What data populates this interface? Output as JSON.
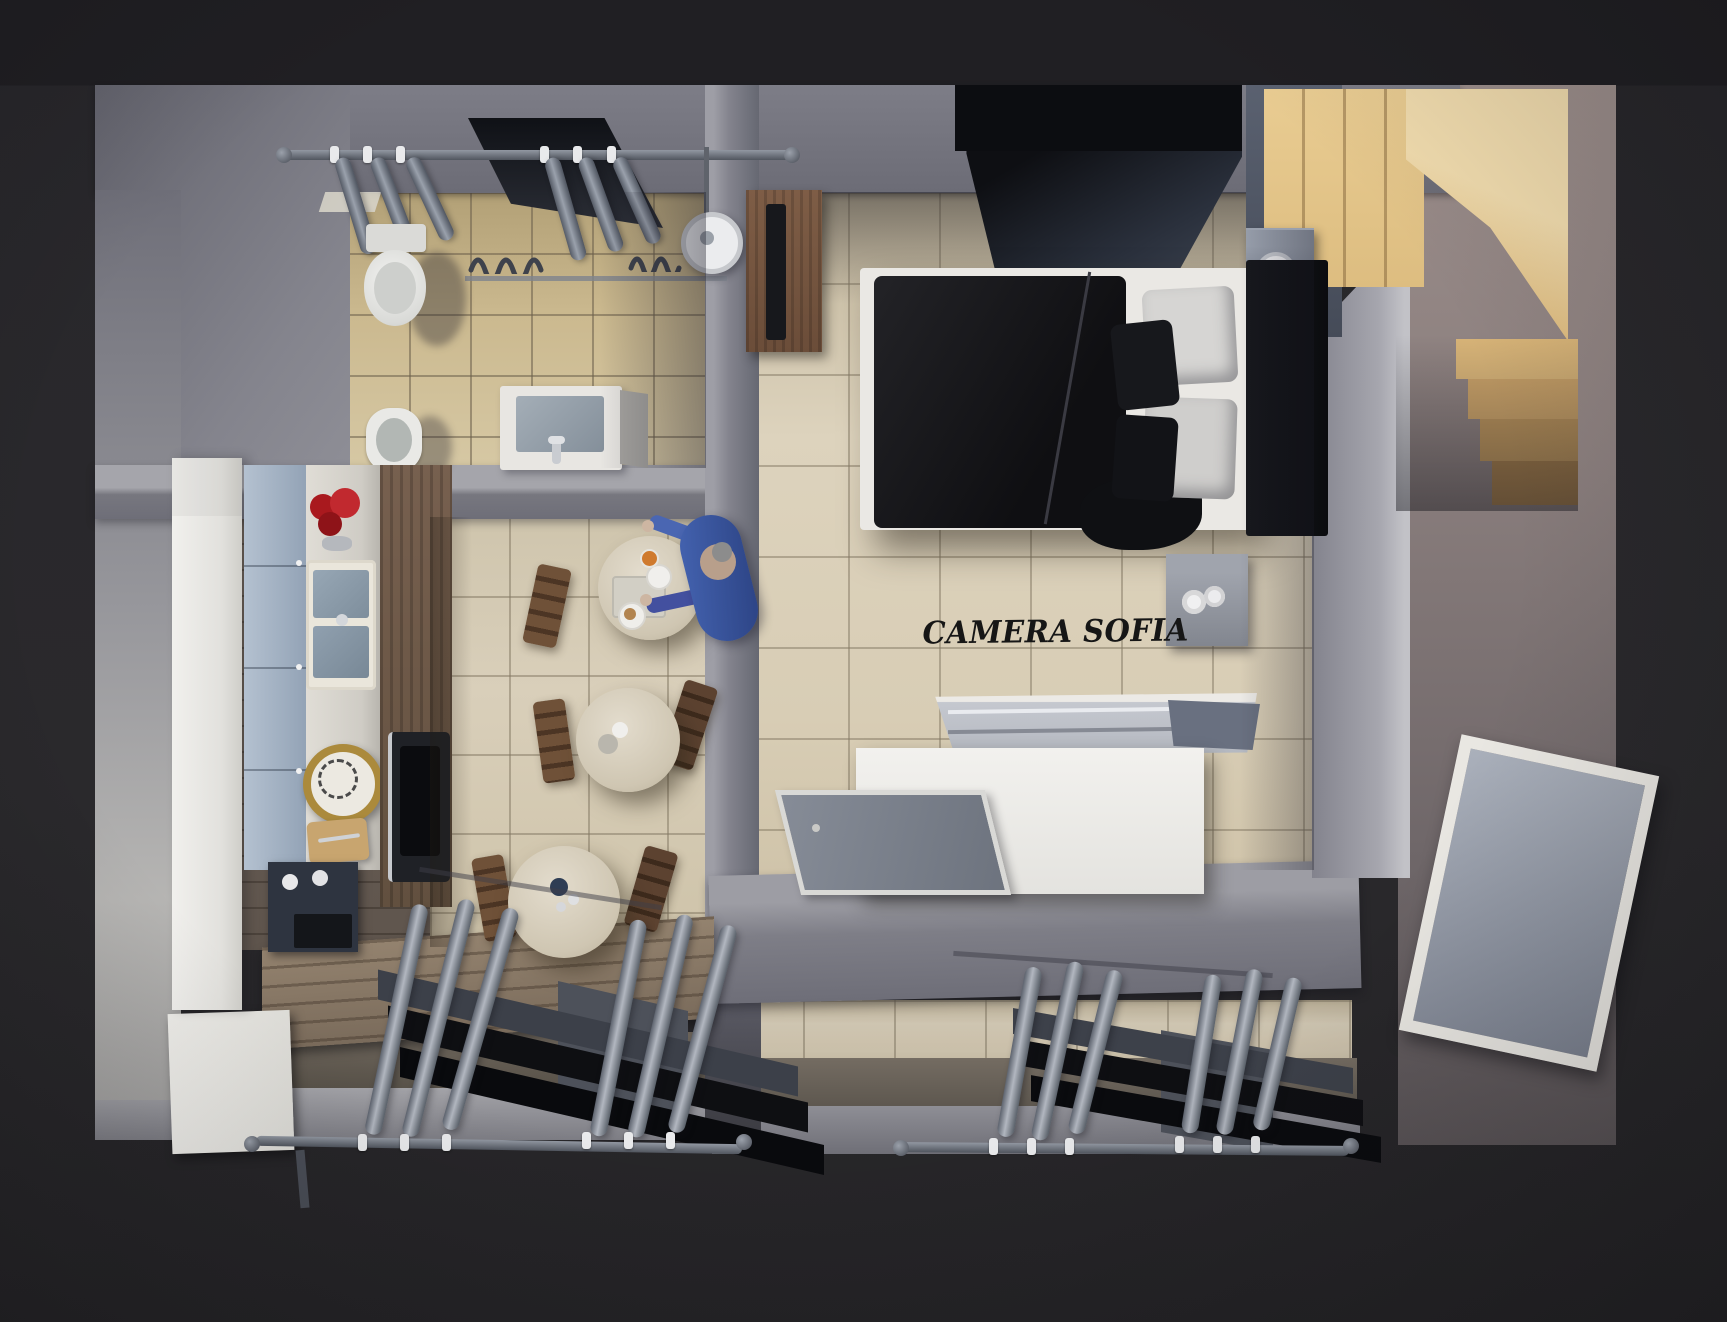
{
  "scene": {
    "type": "3d-apartment-floor-plan-render",
    "bedroom_label": "CAMERA SOFIA",
    "colors": {
      "background": "#28272b",
      "wall": "#85858e",
      "wall_light": "#a6a6ac",
      "bathroom_floor": "#cbb98f",
      "dining_floor": "#d9cfba",
      "bedroom_floor": "#ddd3bd",
      "kitchen_wood": "#6f645b",
      "stairs_wood": "#e6c88d",
      "bed_duvet": "#141518",
      "bed_frame": "#eae8e4",
      "curtain_gray": "#aab1bc",
      "flowers_red": "#b32025",
      "person_shirt": "#3f5fae",
      "label_color": "#161616"
    },
    "rooms": {
      "bathroom": {
        "items": [
          "window-niche",
          "curtains",
          "toilet",
          "bidet",
          "sink",
          "shower"
        ]
      },
      "kitchen": {
        "items": [
          "tall-cabinet",
          "base-cabinets",
          "countertop",
          "flower-vase",
          "kitchen-sink",
          "gold-clock",
          "cutting-board",
          "oven",
          "shelf-unit"
        ]
      },
      "dining": {
        "tables": 3,
        "chairs": 5,
        "people": 1
      },
      "bedroom": {
        "label": "CAMERA SOFIA",
        "items": [
          "double-bed",
          "wardrobe",
          "desk",
          "tv",
          "bedside-table",
          "lamp",
          "nightstand",
          "white-chest",
          "floor-mat",
          "staircase"
        ]
      },
      "hallway": {
        "items": [
          "door-panel",
          "staircase"
        ]
      },
      "windows": {
        "count": 2,
        "items": [
          "curtain-rod",
          "curtains",
          "window-frame"
        ]
      }
    }
  }
}
